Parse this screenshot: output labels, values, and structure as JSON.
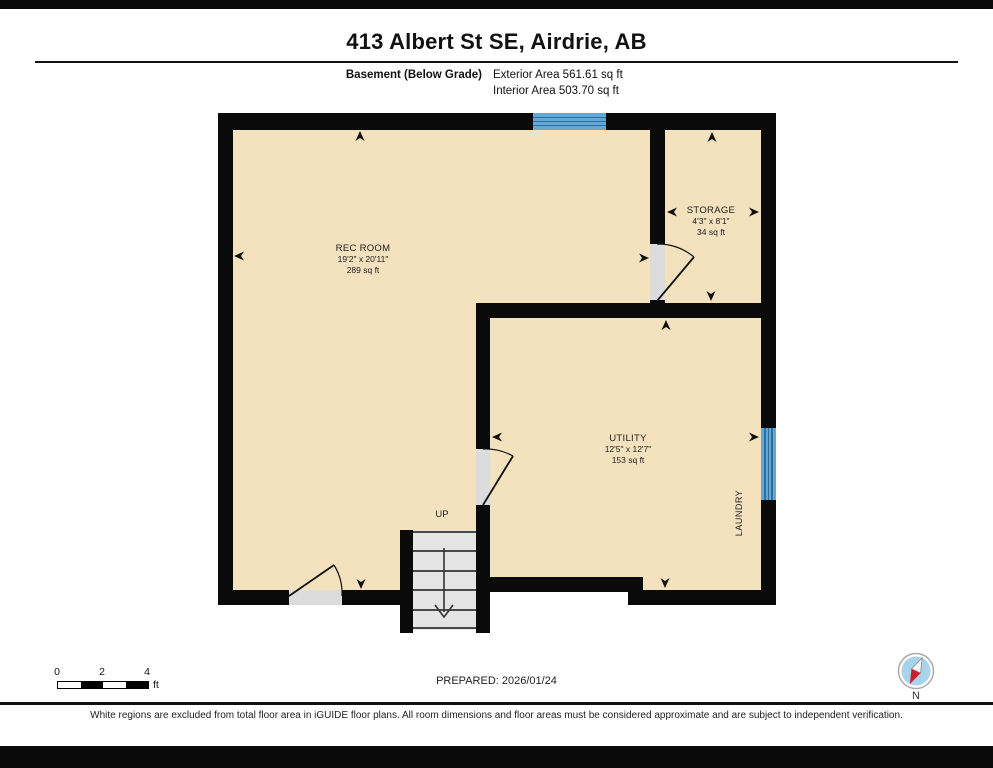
{
  "header": {
    "title": "413 Albert St SE, Airdrie, AB",
    "floor_label": "Basement (Below Grade)",
    "exterior_area": "Exterior Area 561.61 sq ft",
    "interior_area": "Interior Area 503.70 sq ft"
  },
  "rooms": {
    "rec_room": {
      "name": "REC ROOM",
      "dimensions": "19'2\" x 20'11\"",
      "area": "289 sq ft"
    },
    "storage": {
      "name": "STORAGE",
      "dimensions": "4'3\" x 8'1\"",
      "area": "34 sq ft"
    },
    "utility": {
      "name": "UTILITY",
      "dimensions": "12'5\" x 12'7\"",
      "area": "153 sq ft"
    },
    "laundry_label": "LAUNDRY",
    "up_label": "UP"
  },
  "scale_bar": {
    "ticks": [
      "0",
      "2",
      "4"
    ],
    "unit": "ft"
  },
  "footer": {
    "prepared": "PREPARED: 2026/01/24",
    "disclaimer": "White regions are excluded from total floor area in iGUIDE floor plans. All room dimensions and floor areas must be considered approximate and are subject to independent verification.",
    "compass_label": "N"
  },
  "colors": {
    "floor": "#f4e1be",
    "wall": "#0a0a0a",
    "window": "#62a8d4",
    "window_line": "#2f6e9e",
    "stair_tread": "#e4e4e4",
    "door_opening": "#dcdcdc",
    "compass_blue": "#a9d2ec",
    "compass_red": "#c9202c"
  }
}
